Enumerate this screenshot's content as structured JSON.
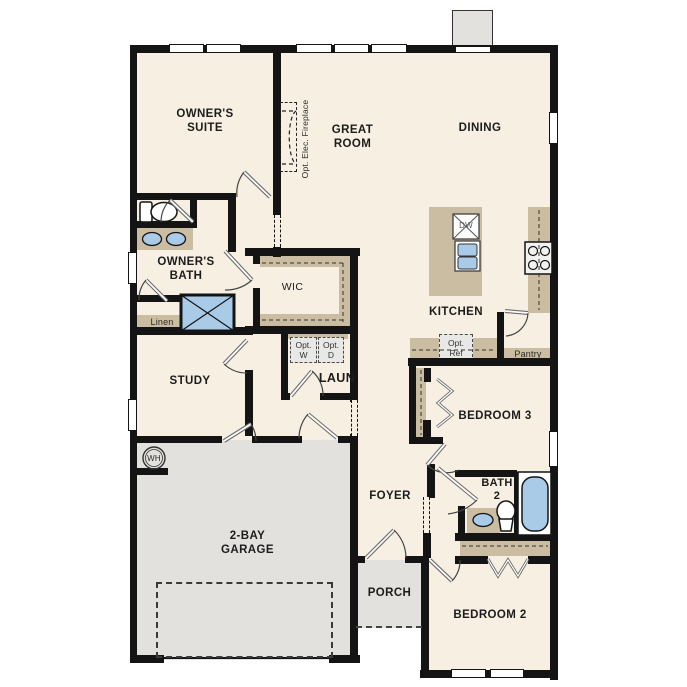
{
  "title": "single-story house floor plan",
  "rooms": [
    {
      "id": "owners-suite",
      "label": "OWNER'S\nSUITE"
    },
    {
      "id": "great-room",
      "label": "GREAT\nROOM"
    },
    {
      "id": "dining",
      "label": "DINING"
    },
    {
      "id": "owners-bath",
      "label": "OWNER'S\nBATH"
    },
    {
      "id": "wic",
      "label": "WIC"
    },
    {
      "id": "kitchen",
      "label": "KITCHEN"
    },
    {
      "id": "study",
      "label": "STUDY"
    },
    {
      "id": "laundry",
      "label": "LAUN"
    },
    {
      "id": "bedroom-3",
      "label": "BEDROOM 3"
    },
    {
      "id": "foyer",
      "label": "FOYER"
    },
    {
      "id": "bath-2",
      "label": "BATH\n2"
    },
    {
      "id": "garage",
      "label": "2-BAY\nGARAGE"
    },
    {
      "id": "porch",
      "label": "PORCH"
    },
    {
      "id": "bedroom-2",
      "label": "BEDROOM 2"
    }
  ],
  "annotations": {
    "fireplace": "Opt. Elec. Fireplace",
    "linen": "Linen",
    "pantry": "Pantry",
    "opt_washer": "Opt.\nW",
    "opt_dryer": "Opt.\nD",
    "opt_ref": "Opt.\nRef",
    "dishwasher": "DW",
    "water_heater": "WH"
  },
  "colors": {
    "wall": "#141414",
    "floor": "#f7efe2",
    "garage_floor": "#e3e1de",
    "cabinet_tan": "#cbbda2",
    "fixture_blue": "#a9cbe8",
    "optional_gray": "#e8e8e6"
  }
}
